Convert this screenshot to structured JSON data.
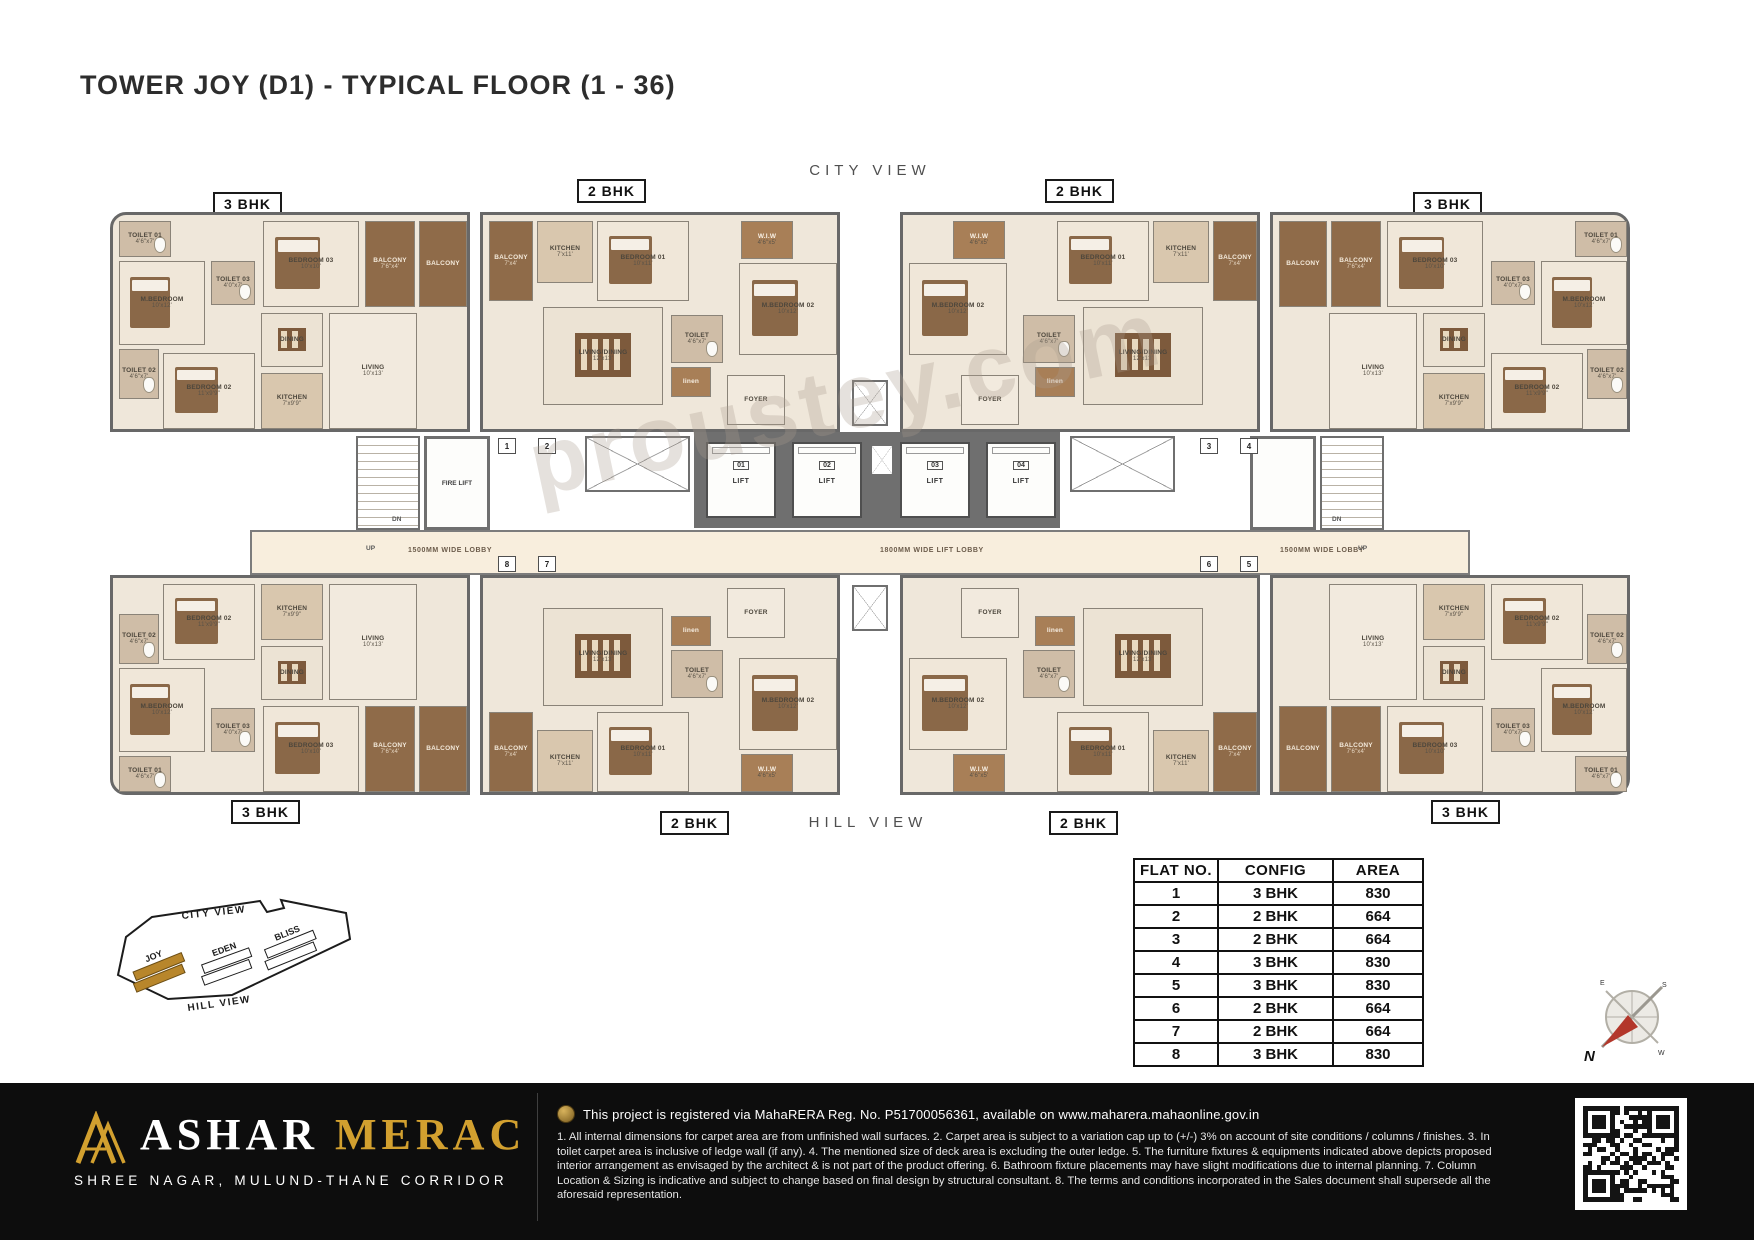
{
  "page": {
    "title": "TOWER JOY (D1) - TYPICAL FLOOR (1 - 36)"
  },
  "plan": {
    "top_view_label": "CITY VIEW",
    "bottom_view_label": "HILL VIEW",
    "bhk_top": [
      "3 BHK",
      "2 BHK",
      "2 BHK",
      "3 BHK"
    ],
    "bhk_bottom": [
      "3 BHK",
      "2 BHK",
      "2 BHK",
      "3 BHK"
    ],
    "corridor": {
      "left": "1500MM WIDE LOBBY",
      "center": "1800MM WIDE LIFT LOBBY",
      "right": "1500MM WIDE LOBBY"
    },
    "lifts": [
      {
        "no": "01",
        "label": "LIFT"
      },
      {
        "no": "02",
        "label": "LIFT"
      },
      {
        "no": "03",
        "label": "LIFT"
      },
      {
        "no": "04",
        "label": "LIFT"
      }
    ],
    "fire_lift": "FIRE LIFT",
    "stairs": {
      "up": "UP",
      "dn": "DN"
    },
    "door_markers": {
      "top": [
        "1",
        "2",
        "3",
        "4"
      ],
      "bottom": [
        "8",
        "7",
        "6",
        "5"
      ]
    },
    "watermark": "proustey.com",
    "rooms_3bhk": [
      {
        "name": "TOILET 01",
        "dim": "4'6\"x7'"
      },
      {
        "name": "M.BEDROOM",
        "dim": "10'x12'"
      },
      {
        "name": "TOILET 02",
        "dim": "4'6\"x7'"
      },
      {
        "name": "BEDROOM 02",
        "dim": "11'x9'9\""
      },
      {
        "name": "KITCHEN",
        "dim": "7'x9'9\""
      },
      {
        "name": "TOILET 03",
        "dim": "4'0\"x7'"
      },
      {
        "name": "BEDROOM 03",
        "dim": "10'x10'"
      },
      {
        "name": "DINING",
        "dim": ""
      },
      {
        "name": "LIVING",
        "dim": "10'x13'"
      },
      {
        "name": "BALCONY",
        "dim": "7'6\"x4'"
      },
      {
        "name": "BALCONY",
        "dim": ""
      }
    ],
    "rooms_2bhk": [
      {
        "name": "BALCONY",
        "dim": "7'x4'"
      },
      {
        "name": "KITCHEN",
        "dim": "7'x11'"
      },
      {
        "name": "BEDROOM 01",
        "dim": "10'x11'"
      },
      {
        "name": "M.BEDROOM 02",
        "dim": "10'x12'"
      },
      {
        "name": "W.I.W",
        "dim": "4'6\"x5'"
      },
      {
        "name": "LIVING/DINING",
        "dim": "12'x13'"
      },
      {
        "name": "TOILET",
        "dim": "4'6\"x7'"
      },
      {
        "name": "linen",
        "dim": ""
      },
      {
        "name": "FOYER",
        "dim": ""
      }
    ]
  },
  "flat_table": {
    "headers": [
      "FLAT NO.",
      "CONFIG",
      "AREA"
    ],
    "rows": [
      [
        "1",
        "3 BHK",
        "830"
      ],
      [
        "2",
        "2 BHK",
        "664"
      ],
      [
        "3",
        "2 BHK",
        "664"
      ],
      [
        "4",
        "3 BHK",
        "830"
      ],
      [
        "5",
        "3 BHK",
        "830"
      ],
      [
        "6",
        "2 BHK",
        "664"
      ],
      [
        "7",
        "2 BHK",
        "664"
      ],
      [
        "8",
        "3 BHK",
        "830"
      ]
    ]
  },
  "key_map": {
    "city_view": "CITY VIEW",
    "hill_view": "HILL VIEW",
    "towers": [
      "JOY",
      "EDEN",
      "BLISS"
    ],
    "highlighted_tower": "JOY"
  },
  "compass": {
    "north": "N",
    "east": "E",
    "south": "S",
    "west": "W"
  },
  "footer": {
    "brand_primary": "ASHAR",
    "brand_secondary": "MERAC",
    "tagline": "SHREE NAGAR, MULUND-THANE CORRIDOR",
    "rera_text": "This project is registered via MahaRERA Reg. No. P51700056361, available on www.maharera.mahaonline.gov.in",
    "disclaimer": "1. All internal dimensions for carpet area are from unfinished wall surfaces. 2. Carpet area is subject to a variation cap up to (+/-) 3% on account of site conditions / columns / finishes. 3. In toilet carpet area is inclusive of ledge wall (if any). 4. The mentioned size of deck area is excluding the outer ledge. 5. The furniture fixtures & equipments indicated above depicts proposed interior arrangement as envisaged by the architect & is not part of the product offering. 6. Bathroom fixture placements may have slight modifications due to internal planning. 7. Column Location & Sizing is indicative and subject to change based on final design by structural consultant. 8. The terms and conditions incorporated in the Sales document shall supersede all the aforesaid representation."
  },
  "colors": {
    "gold": "#D2A02F",
    "footer_bg": "#0D0D0D",
    "wall_gray": "#6B6B6B",
    "floor_beige": "#EFE7DA",
    "balcony_brown": "#8F6B49",
    "compass_red": "#B3372B",
    "highlight_gold": "#B8862B"
  }
}
